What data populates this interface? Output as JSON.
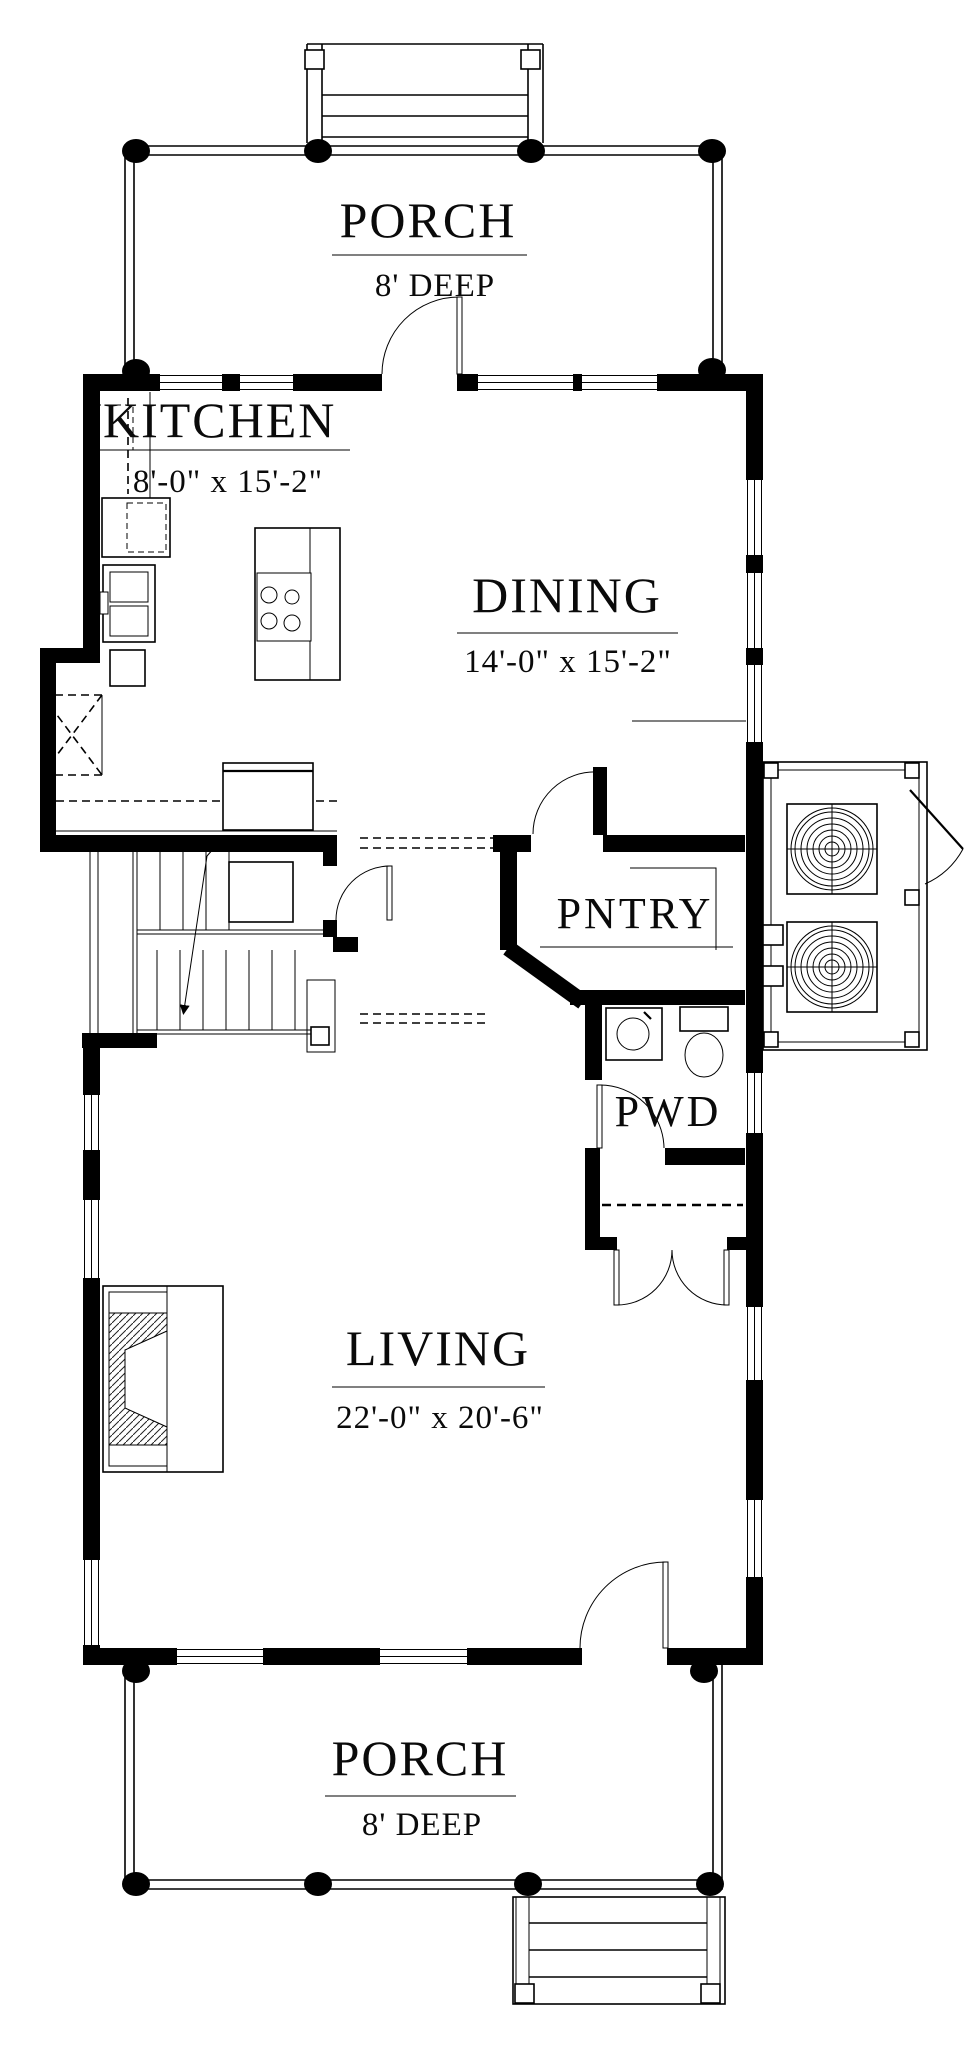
{
  "document": {
    "kind": "architectural floor plan",
    "paper_color": "#ffffff",
    "ink_color": "#000000"
  },
  "rooms": {
    "porch_top": {
      "name": "PORCH",
      "size": "8' DEEP"
    },
    "kitchen": {
      "name": "KITCHEN",
      "size": "8'-0\" x 15'-2\""
    },
    "dining": {
      "name": "DINING",
      "size": "14'-0\" x 15'-2\""
    },
    "pantry": {
      "name": "PNTRY"
    },
    "powder": {
      "name": "PWD"
    },
    "living": {
      "name": "LIVING",
      "size": "22'-0\" x 20'-6\""
    },
    "porch_bottom": {
      "name": "PORCH",
      "size": "8' DEEP"
    }
  }
}
